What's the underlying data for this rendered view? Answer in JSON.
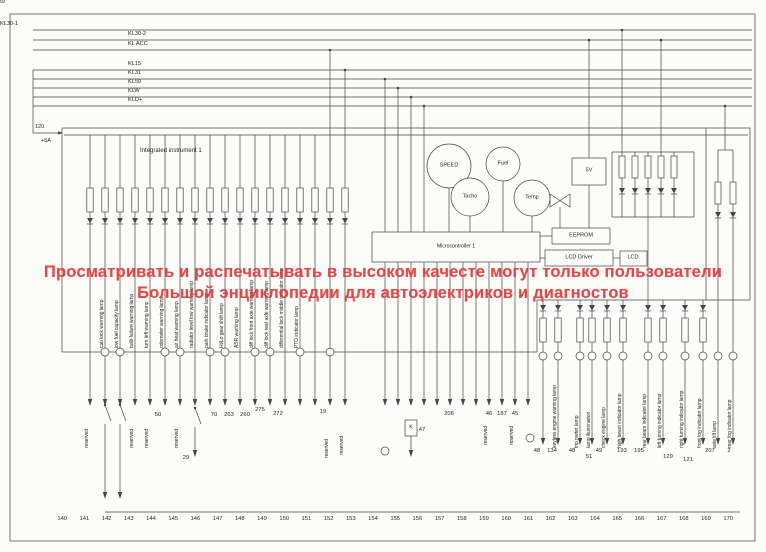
{
  "watermark": {
    "line1": "Просматривать и распечатывать в высоком качесте могут только пользователи",
    "line2": "Большой энциклопедии для автоэлектриков и диагностов",
    "color": "#e03636"
  },
  "bus_labels": [
    "KL30-1",
    "KL30-2",
    "KL ACC",
    "KL15",
    "KL31",
    "KL50",
    "KLW",
    "KLD+"
  ],
  "left_marks": [
    "120",
    "+5A"
  ],
  "instrument": {
    "label": "Integrated instrument 1"
  },
  "gauges": {
    "speed": "SPEED",
    "fuel": "Fuel",
    "tacho": "Tacho",
    "temp": "Temp"
  },
  "modules": {
    "v5": "5V",
    "eeprom": "EEPROM",
    "lcd_driver": "LCD Driver",
    "lcd": "LCD",
    "mcu": "Microcontroller 1",
    "relay": "K"
  },
  "lamp_labels_left": [
    "ABS warning lamp",
    "cab lock warning lamp",
    "low fuel capacity lamp",
    "bulb failure warning lamp",
    "turn left warning lamp",
    "odometer warning lamp",
    "air heat warning lamp",
    "radiator level low warning lamp",
    "park brake indicator lamp",
    "Hi/Lo gear shift lamp",
    "ASR warning lamp",
    "diff lock front axle warning lamp",
    "diff lock rear axle warning lamp",
    "differential lock middle indicator lamp",
    "PTO indicator lamp"
  ],
  "lamp_labels_right": [
    "oil level warning lamp",
    "keyless engine warning lamp",
    "trip meter lamp",
    "lamp illumination",
    "check engine lamp",
    "high beam indicator lamp",
    "rear beam indicator lamp",
    "left turning indicator lamp",
    "right turning indicator lamp",
    "front fog indicator lamp",
    "axle lift lamp",
    "rear fog indicator lamp"
  ],
  "reserved_labels": [
    "reserved",
    "reserved",
    "reserved",
    "reserved",
    "reserved",
    "reserved",
    "reserved",
    "reserved"
  ],
  "wire_numbers": [
    "50",
    "70",
    "263",
    "260",
    "275",
    "272",
    "19",
    "29",
    "47",
    "206",
    "46",
    "187",
    "45",
    "48",
    "134",
    "48",
    "51",
    "49",
    "193",
    "195",
    "129",
    "121",
    "207",
    "2"
  ],
  "connector_numbers": [
    "139",
    "140",
    "141",
    "142",
    "143",
    "144",
    "145",
    "146",
    "147",
    "148",
    "149",
    "150",
    "151",
    "152",
    "153",
    "154",
    "155",
    "156",
    "157",
    "158",
    "159",
    "160",
    "161",
    "162",
    "163",
    "164",
    "165",
    "166",
    "167",
    "168",
    "169",
    "170"
  ]
}
